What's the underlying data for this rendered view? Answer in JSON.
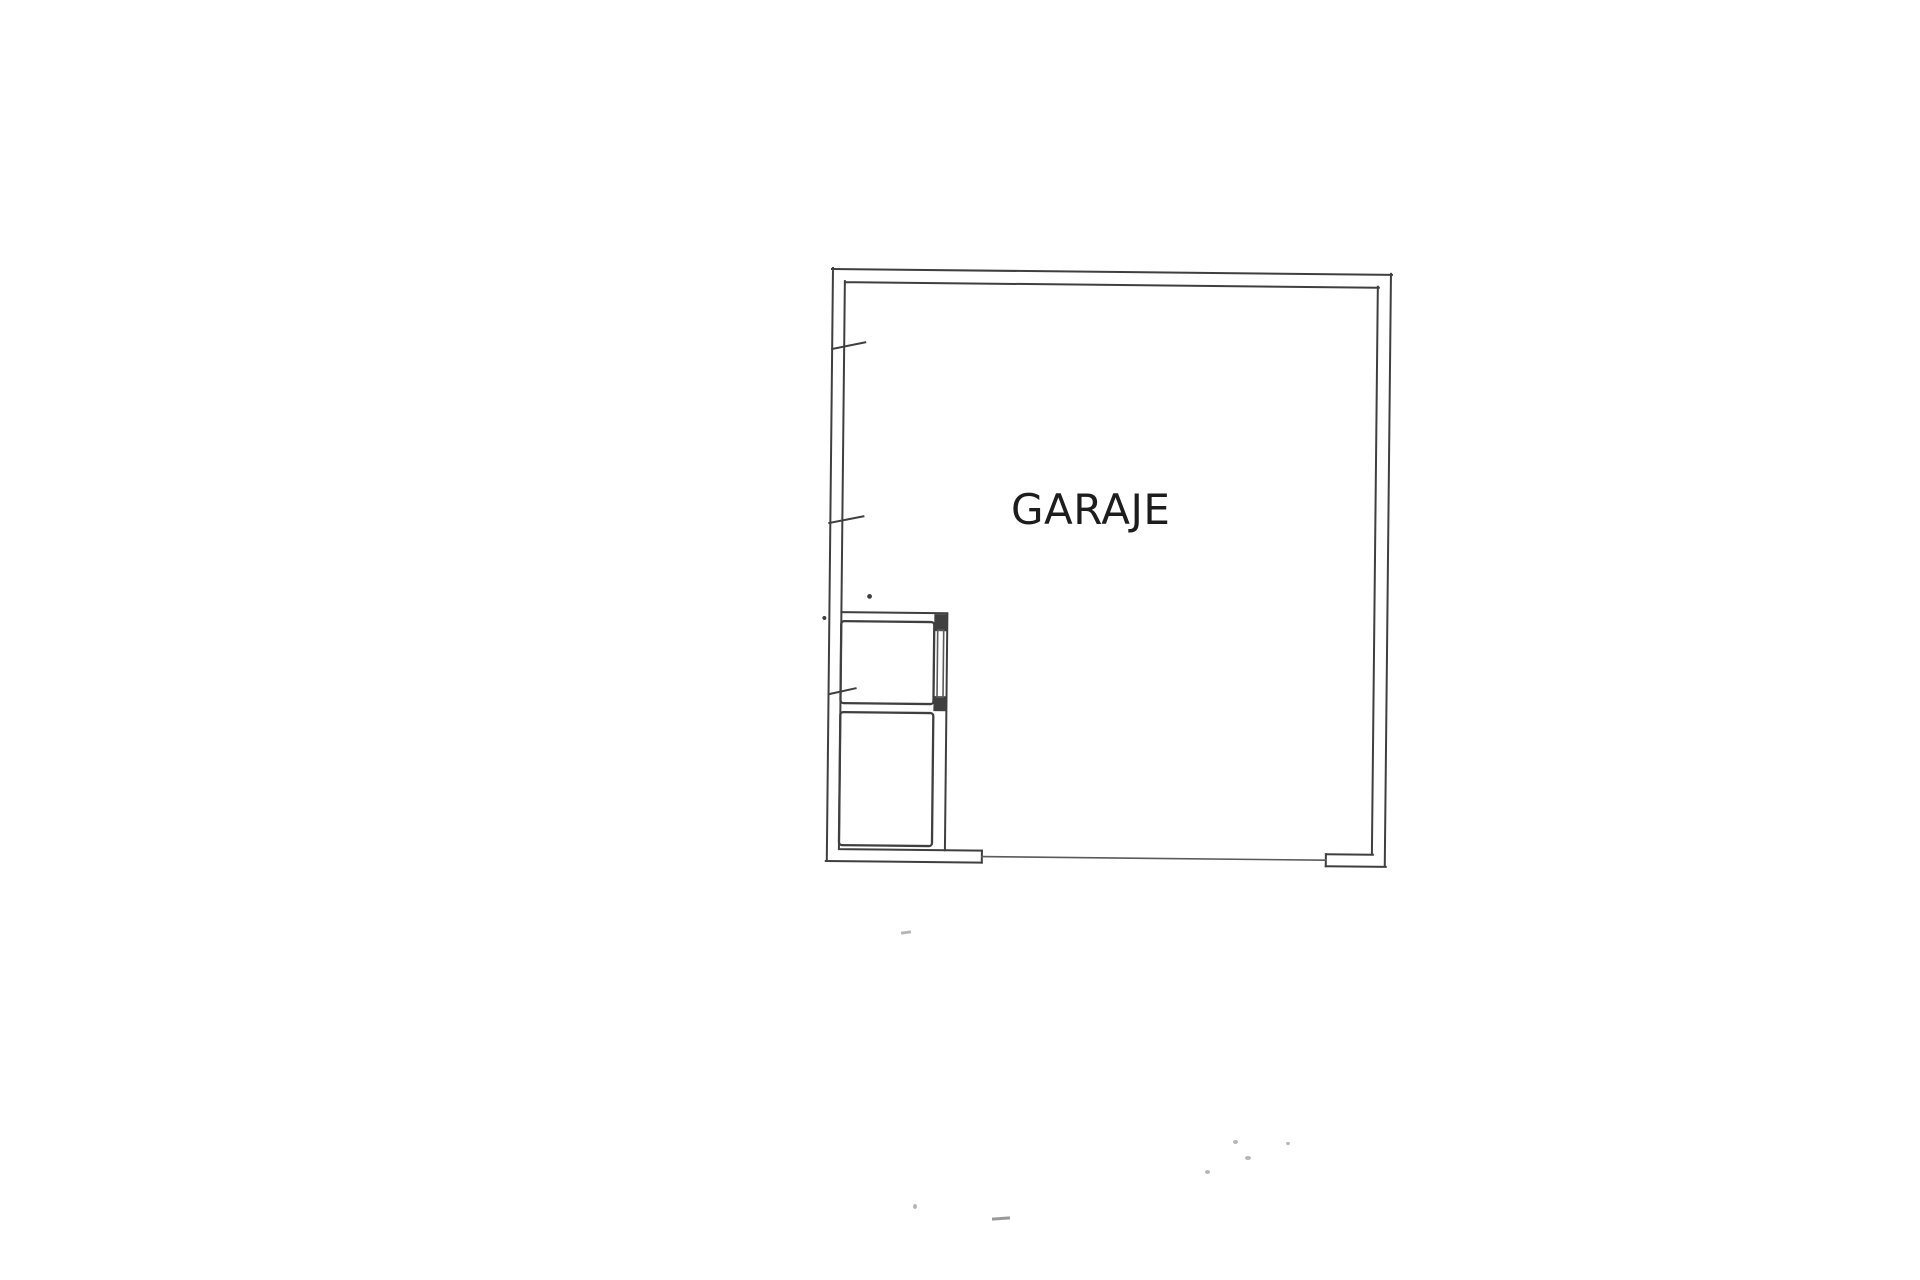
{
  "plan": {
    "room_label": "GARAJE"
  },
  "colors": {
    "paper": "#ffffff",
    "line": "#3f3f3f",
    "text": "#1d1d1d",
    "speck": "#b6b6b6"
  }
}
